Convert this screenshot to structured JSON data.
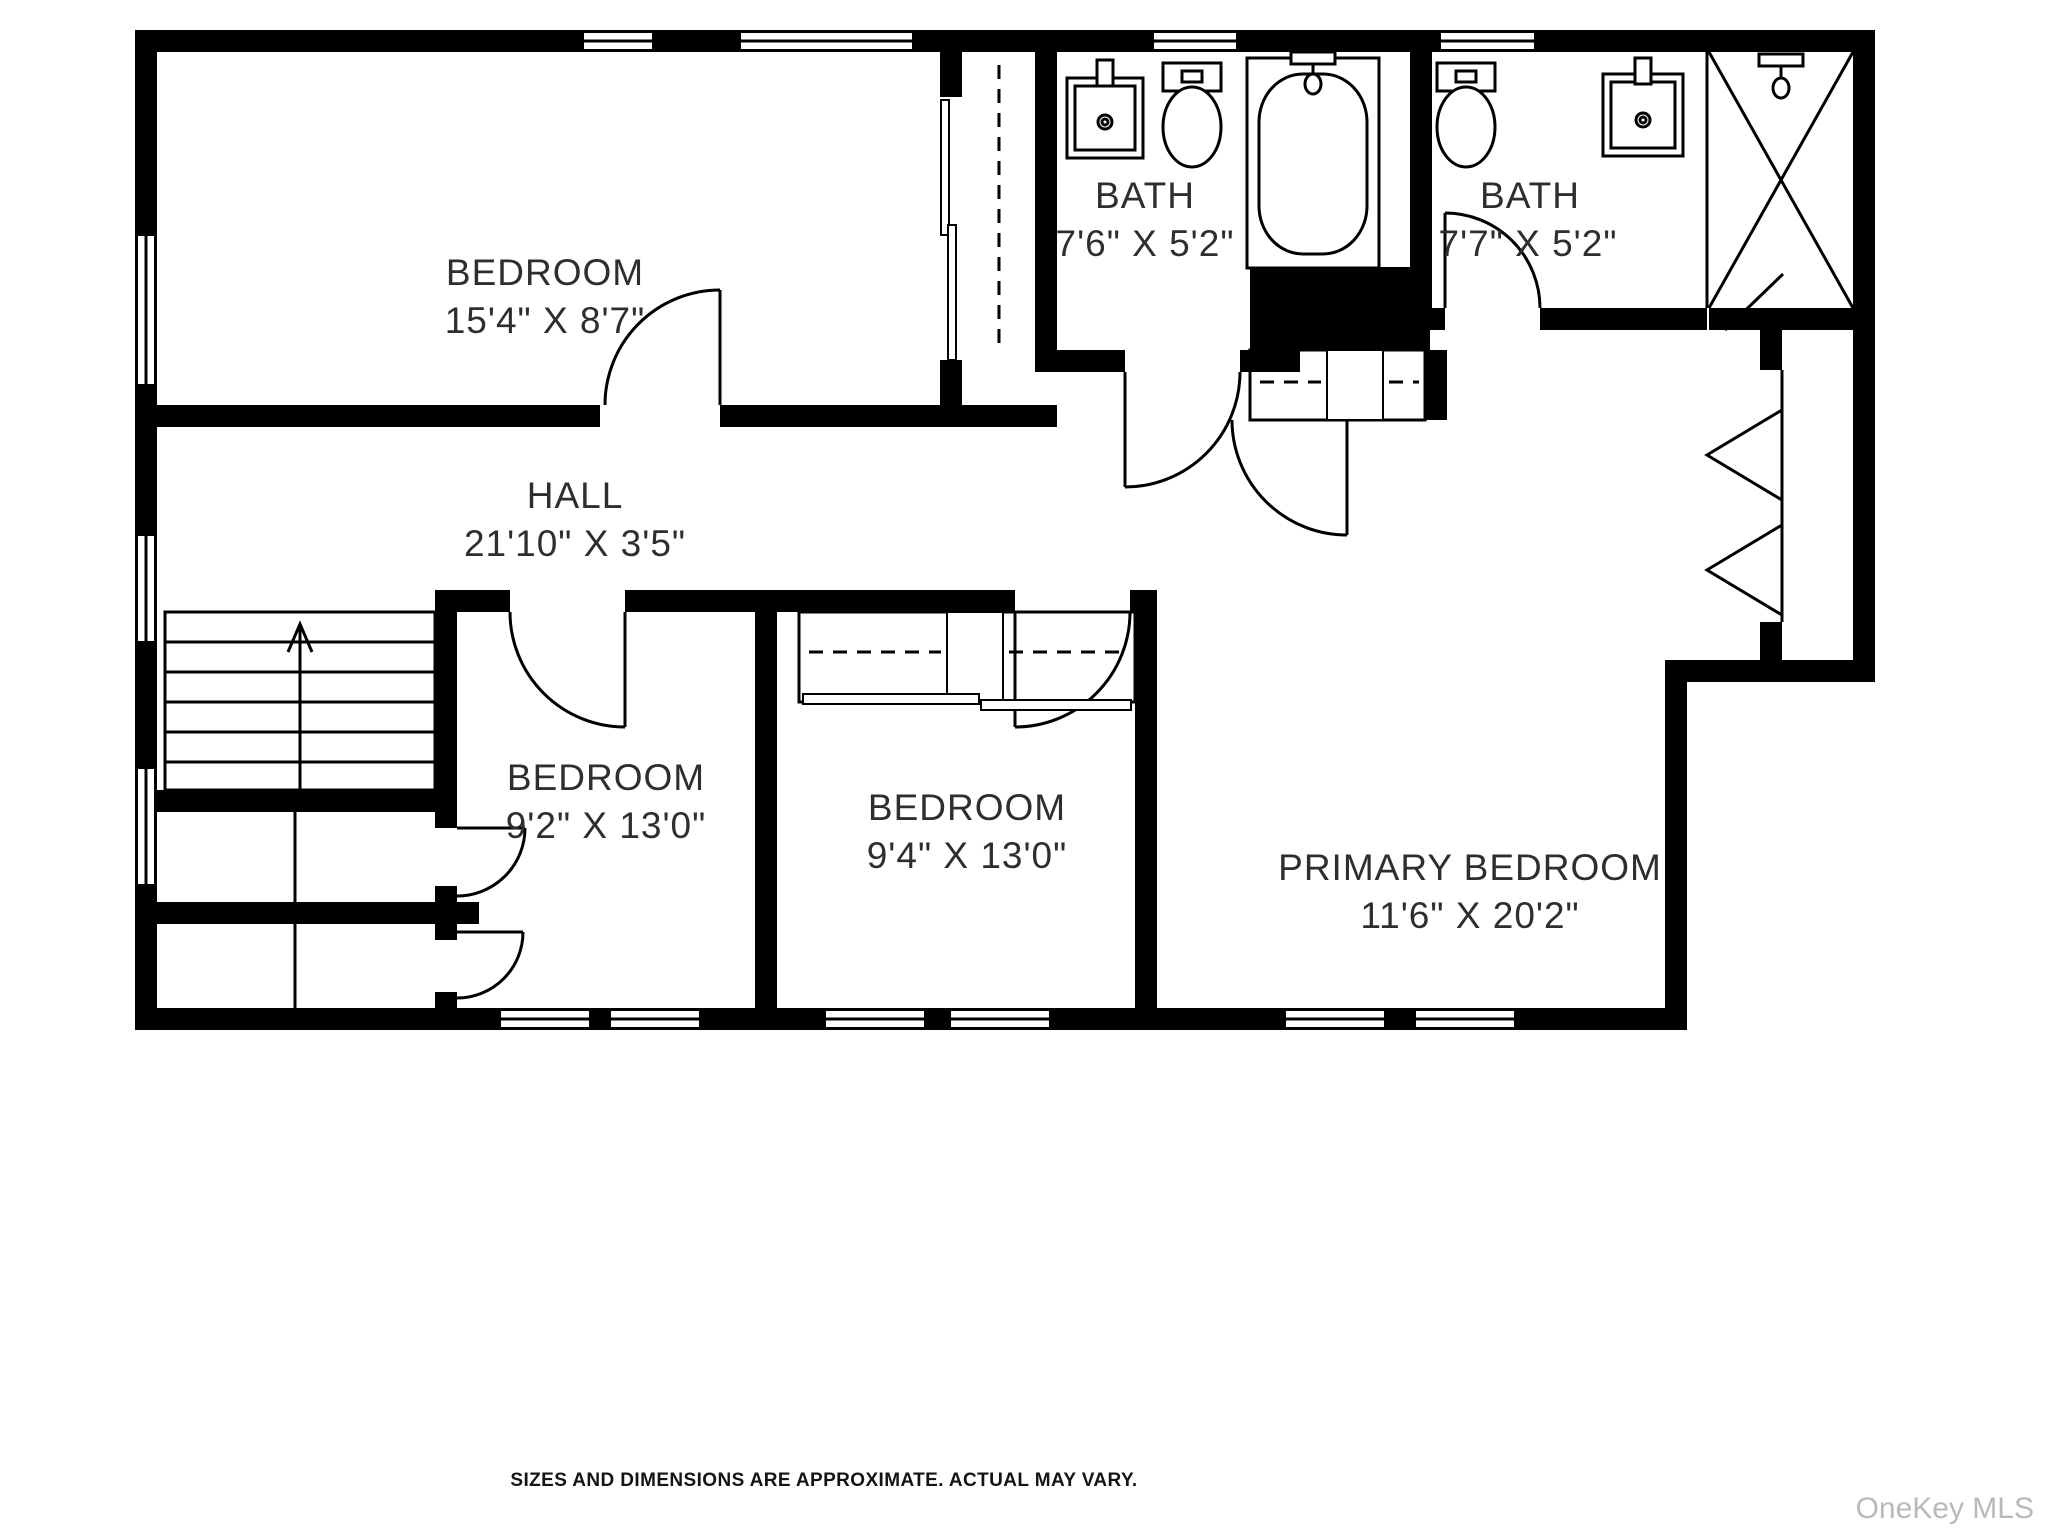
{
  "plan": {
    "wall_color": "#000000",
    "label_color": "#2e2e2e",
    "rooms": [
      {
        "id": "bedroom-top-left",
        "name": "BEDROOM",
        "dimensions": "15'4\" X 8'7\""
      },
      {
        "id": "bath-1",
        "name": "BATH",
        "dimensions": "7'6\" X 5'2\""
      },
      {
        "id": "bath-2",
        "name": "BATH",
        "dimensions": "7'7\" X 5'2\""
      },
      {
        "id": "hall",
        "name": "HALL",
        "dimensions": "21'10\" X 3'5\""
      },
      {
        "id": "bedroom-bottom-left",
        "name": "BEDROOM",
        "dimensions": "9'2\" X 13'0\""
      },
      {
        "id": "bedroom-middle",
        "name": "BEDROOM",
        "dimensions": "9'4\" X 13'0\""
      },
      {
        "id": "primary-bedroom",
        "name": "PRIMARY BEDROOM",
        "dimensions": "11'6\" X 20'2\""
      }
    ],
    "features": {
      "stairs": "up",
      "fixtures": [
        "sink",
        "toilet",
        "bathtub",
        "toilet",
        "sink",
        "shower"
      ]
    }
  },
  "footer": {
    "disclaimer": "SIZES AND DIMENSIONS ARE APPROXIMATE. ACTUAL MAY VARY."
  },
  "watermark": {
    "text": "OneKey MLS"
  }
}
